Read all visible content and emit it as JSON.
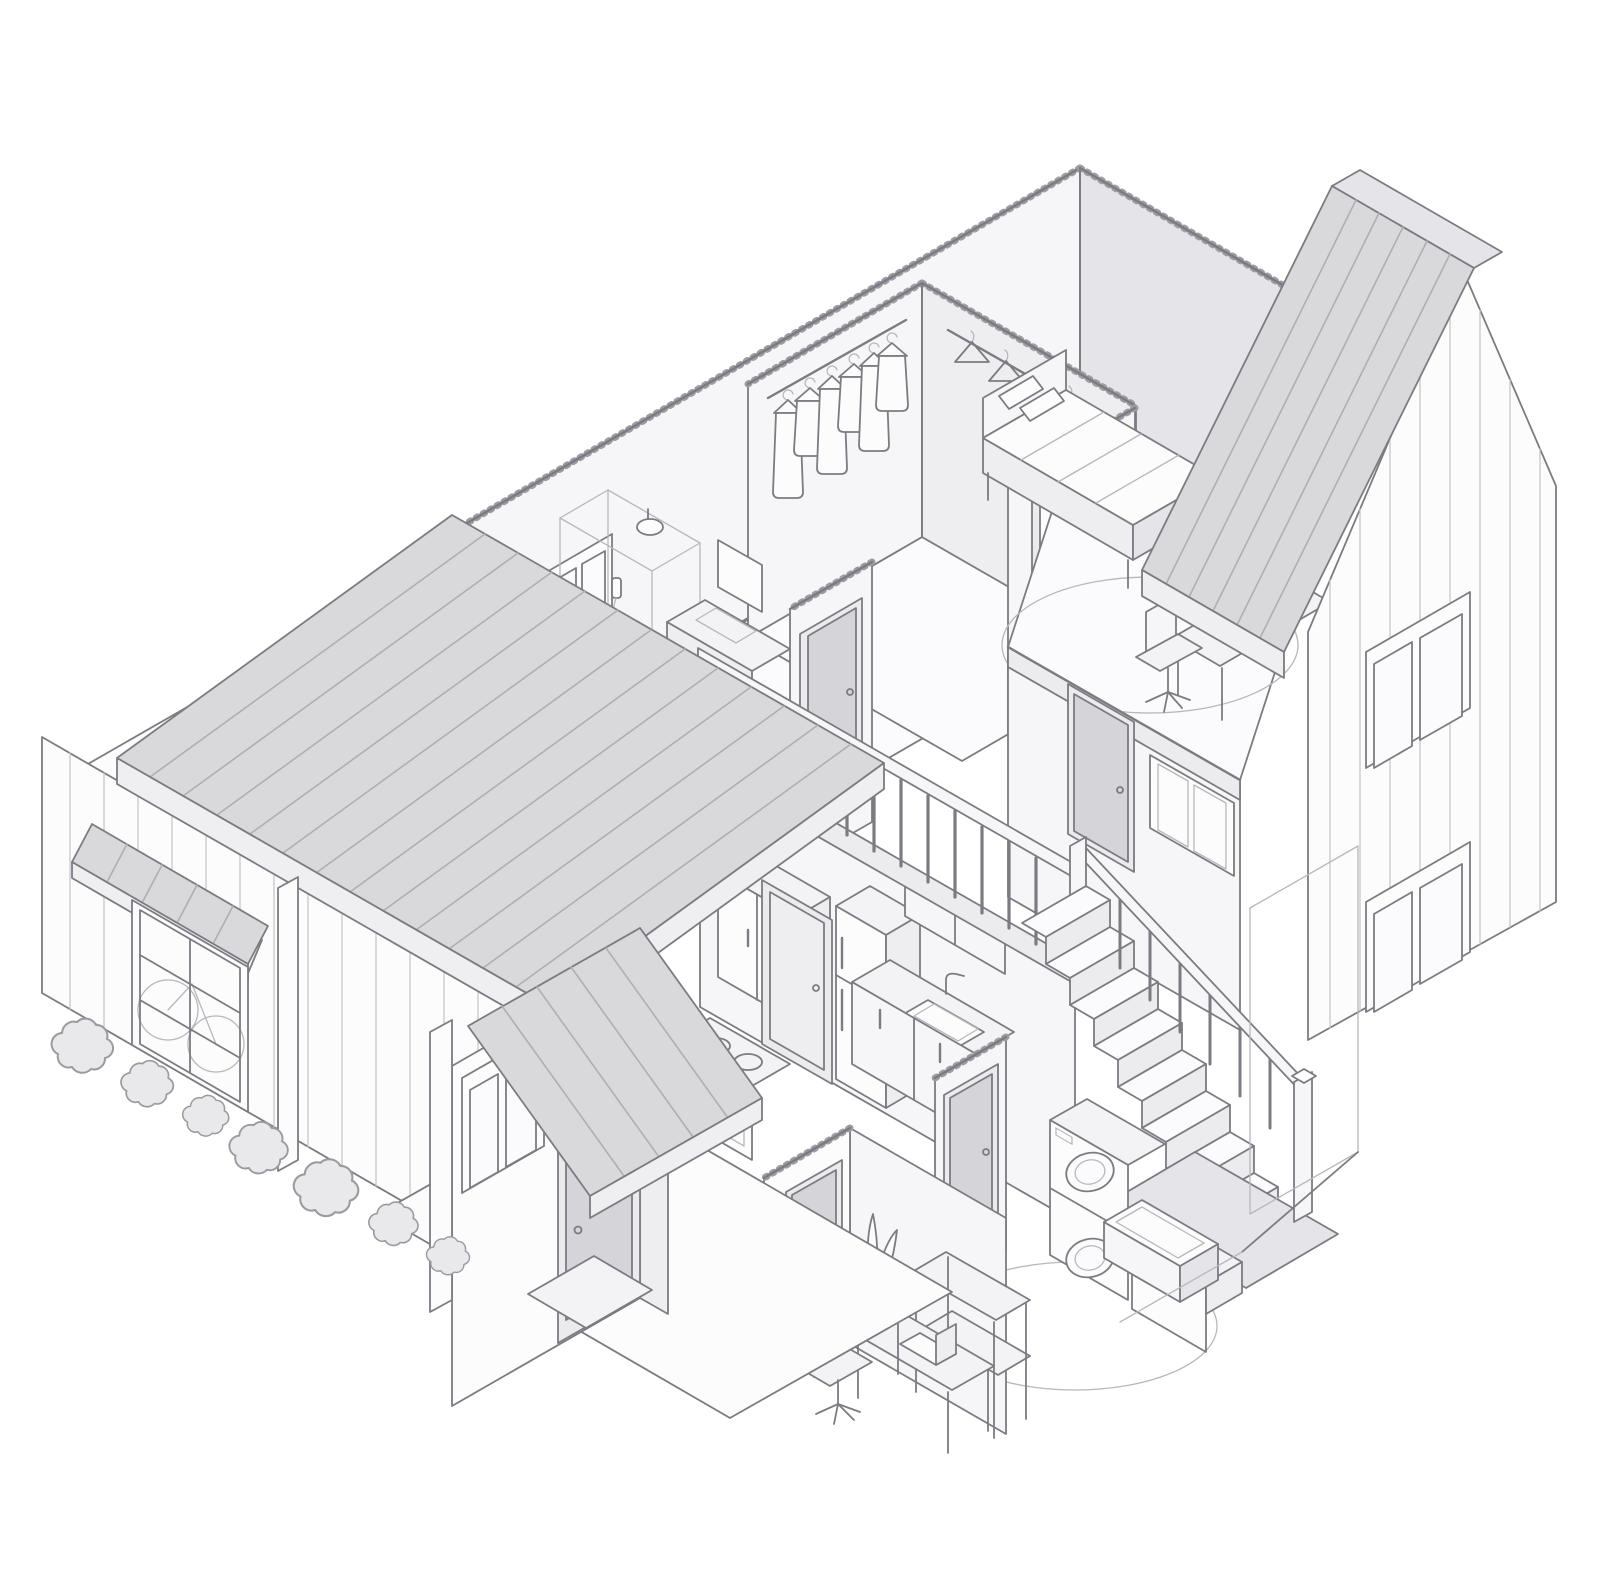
{
  "scene": {
    "type": "Isometric cutaway illustration of a two-story house",
    "style": "grayscale architectural line art, no text labels",
    "rooms": [
      {
        "name": "walk-in-closet",
        "items": [
          "clothes rod with hanging garments",
          "rod with empty hangers"
        ]
      },
      {
        "name": "bedroom",
        "items": [
          "bed with striped duvet and pillows",
          "oval rug",
          "desk with laptop",
          "office chair",
          "interior door"
        ]
      },
      {
        "name": "bathroom",
        "items": [
          "window",
          "bathtub",
          "glass shower enclosure with rain head and hand shower",
          "vanity with sink",
          "mirror",
          "interior door"
        ]
      },
      {
        "name": "landing-and-stairs",
        "items": [
          "balustrade with handrail",
          "staircase descending with railing",
          "newel posts",
          "interior doors",
          "interior window",
          "lower landing slab"
        ]
      },
      {
        "name": "kitchen",
        "items": [
          "tall pantry cabinet",
          "cooktop stove with burners",
          "refrigerator cabinet",
          "sink counter with faucet",
          "base cabinets",
          "upper cabinet",
          "interior door"
        ]
      },
      {
        "name": "laundry-room",
        "items": [
          "stacked washer and dryer",
          "laundry basket on low cabinet",
          "oval rug",
          "interior door"
        ]
      },
      {
        "name": "study",
        "items": [
          "desk with laptop",
          "office chair",
          "two-tier shelf",
          "potted snake plant",
          "interior door"
        ]
      },
      {
        "name": "porch",
        "items": [
          "small gabled porch roof",
          "front door",
          "double window",
          "doormat",
          "stone path",
          "porch posts"
        ]
      }
    ],
    "exterior": [
      "large standing-seam gable roof on left wing",
      "vertical board siding",
      "window awning",
      "multi-pane window with bicycle behind",
      "row of seven shrubs",
      "right wing gable roof with seams",
      "gable wall with two double windows",
      "small gable window"
    ]
  },
  "colors": {
    "background": "#ffffff",
    "ink": "#7b7b82",
    "faint": "#b7b7bd",
    "hatch": "#9c9ca2",
    "siding": "#c7c7cc",
    "roofFill": "#d9d9dc",
    "roofSeam": "#aeaeb4",
    "fascia": "#efeff2",
    "wallWhite": "#fcfcfd",
    "wallLight": "#f6f6f8",
    "wallMid": "#eeeef1",
    "wallDark": "#e5e5e9",
    "floor": "#fbfbfd",
    "slab": "#ececef",
    "door": "#d4d4d9",
    "doorFrame": "#ebebee",
    "furn": "#f3f3f5",
    "bushFill": "#e9e9ec",
    "bushStroke": "#9a9aa0"
  }
}
